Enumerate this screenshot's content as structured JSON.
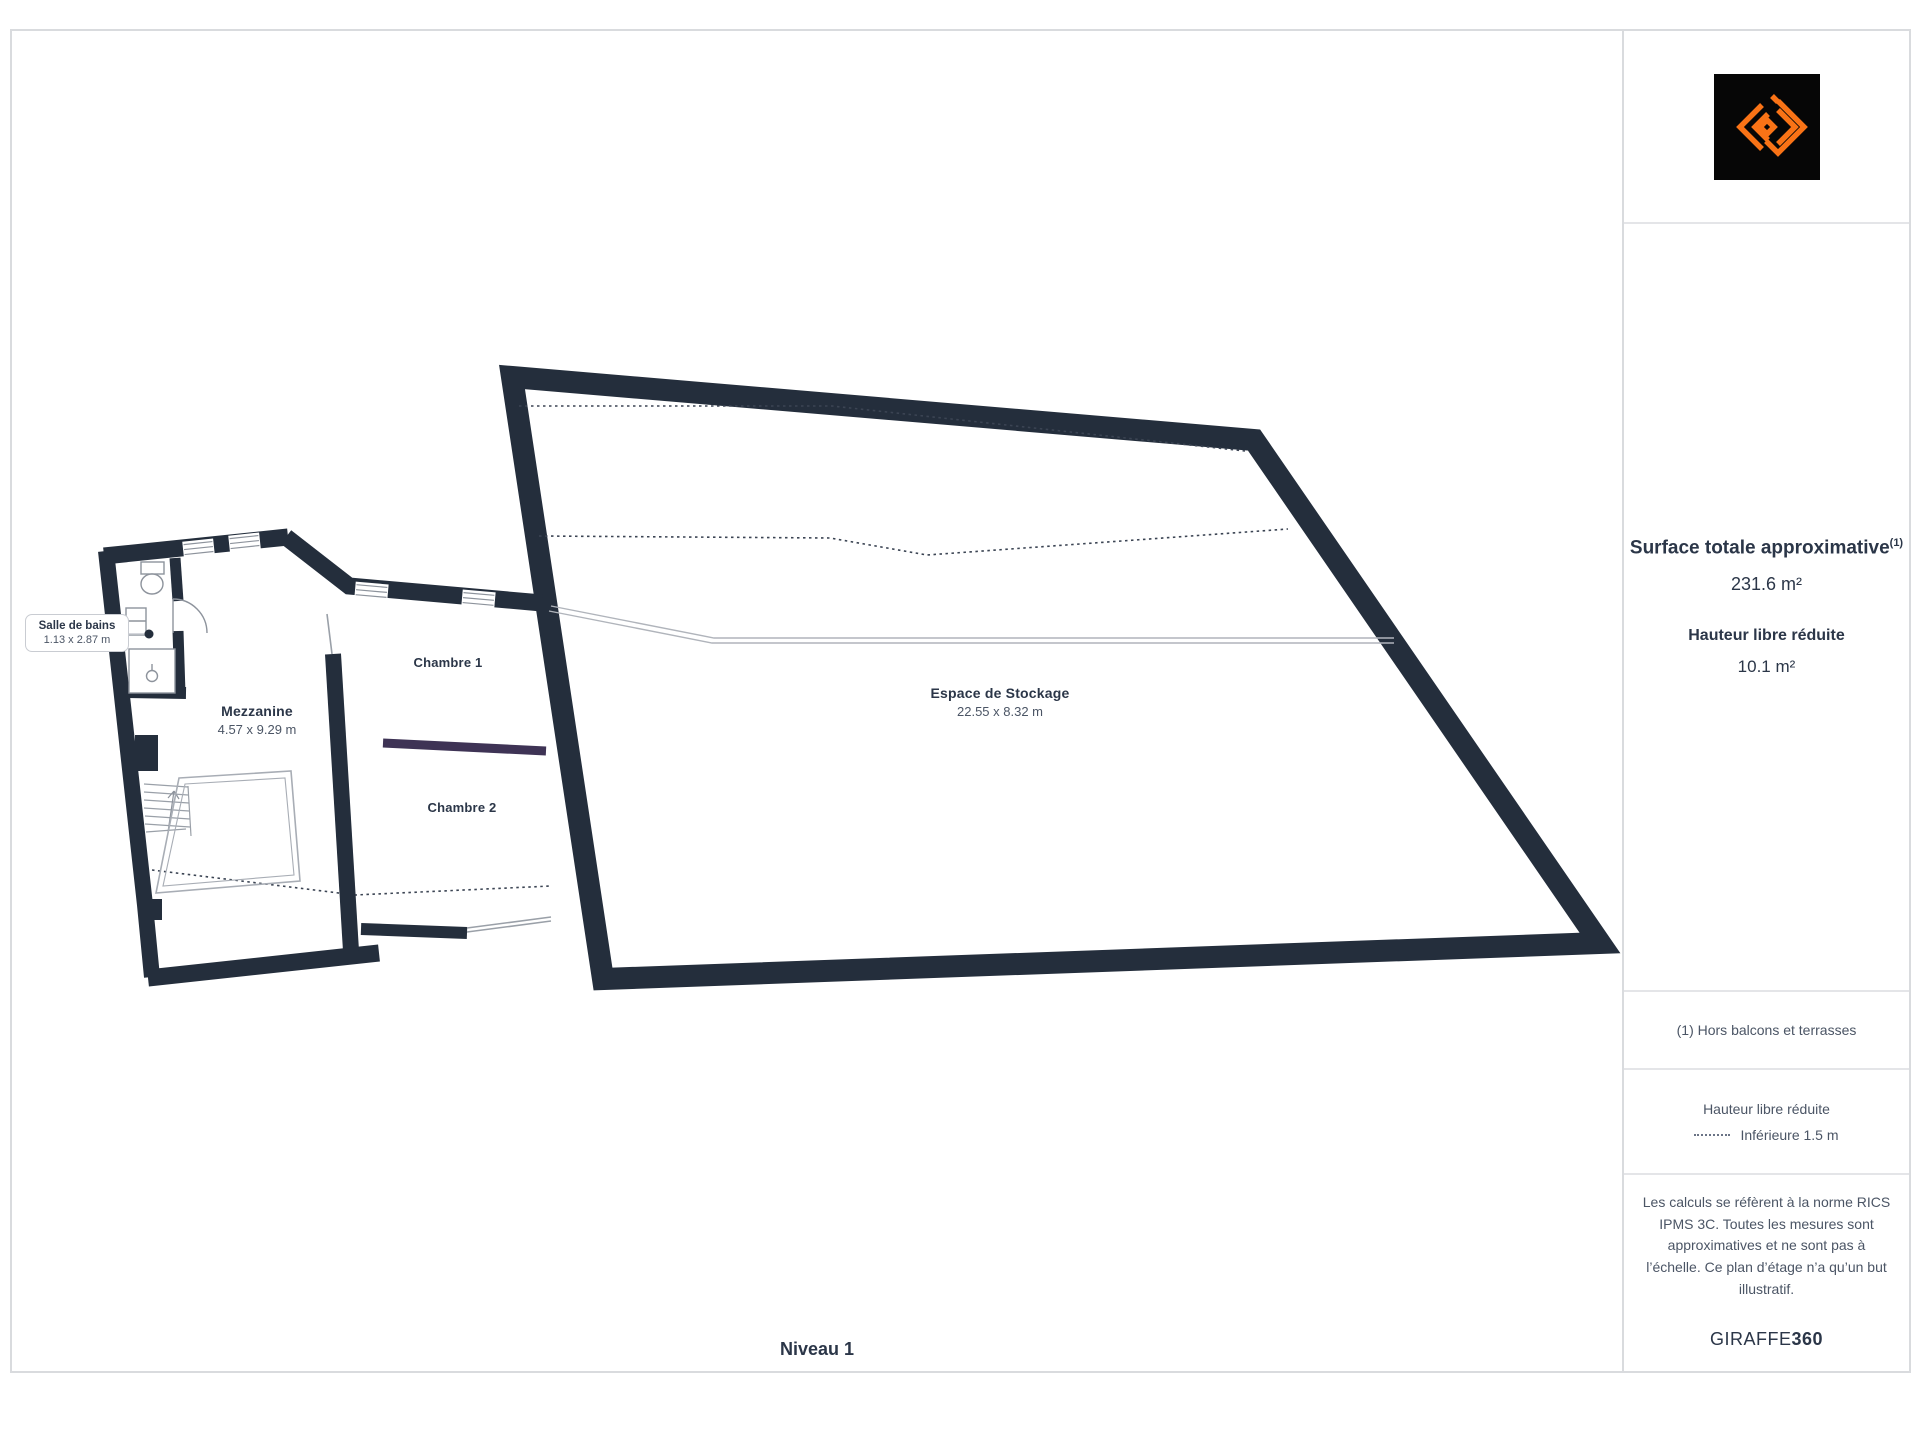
{
  "floor_label": "Niveau 1",
  "rooms": [
    {
      "name": "Salle de bains",
      "dimensions": "1.13 x 2.87 m"
    },
    {
      "name": "Mezzanine",
      "dimensions": "4.57 x 9.29 m"
    },
    {
      "name": "Chambre 1",
      "dimensions": ""
    },
    {
      "name": "Chambre 2",
      "dimensions": ""
    },
    {
      "name": "Espace de Stockage",
      "dimensions": "22.55 x 8.32 m"
    }
  ],
  "sidebar": {
    "surface_title": "Surface totale approximative",
    "surface_sup": "(1)",
    "surface_value": "231.6 m²",
    "reduced_height_title": "Hauteur libre réduite",
    "reduced_height_value": "10.1 m²",
    "footnote": "(1) Hors balcons et terrasses",
    "legend_title": "Hauteur libre réduite",
    "legend_item": "Inférieure 1.5 m",
    "disclaimer": "Les calculs se réfèrent à la norme RICS IPMS 3C. Toutes les mesures sont approximatives et ne sont pas à l’échelle. Ce plan d’étage n’a qu’un but illustratif.",
    "brand_normal": "GIRAFFE",
    "brand_bold": "360"
  },
  "colors": {
    "wall": "#242e3c",
    "divider_purple": "#3e3355",
    "accent_orange": "#f97316",
    "text_navy": "#2b3648",
    "text_gray": "#4b5565"
  }
}
